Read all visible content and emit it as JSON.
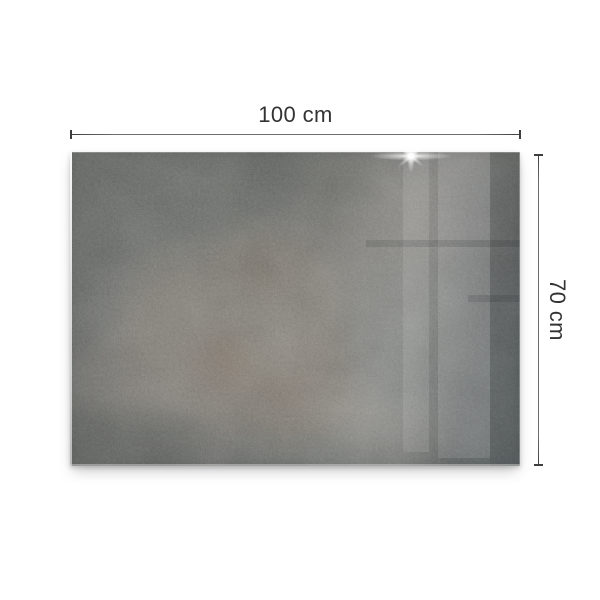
{
  "annotations": {
    "width_label": "100 cm",
    "height_label": "70 cm"
  },
  "panel": {
    "sparkle_icon": "sparkle-icon"
  },
  "colors": {
    "background": "#ffffff",
    "dimension_line": "#6e6e6e",
    "dimension_tick": "#3e3e3e",
    "dimension_text": "#333333",
    "panel_base": "#84857f",
    "panel_dark": "#5f6669",
    "panel_light": "#a09b91",
    "panel_rust": "#7c6a57"
  }
}
